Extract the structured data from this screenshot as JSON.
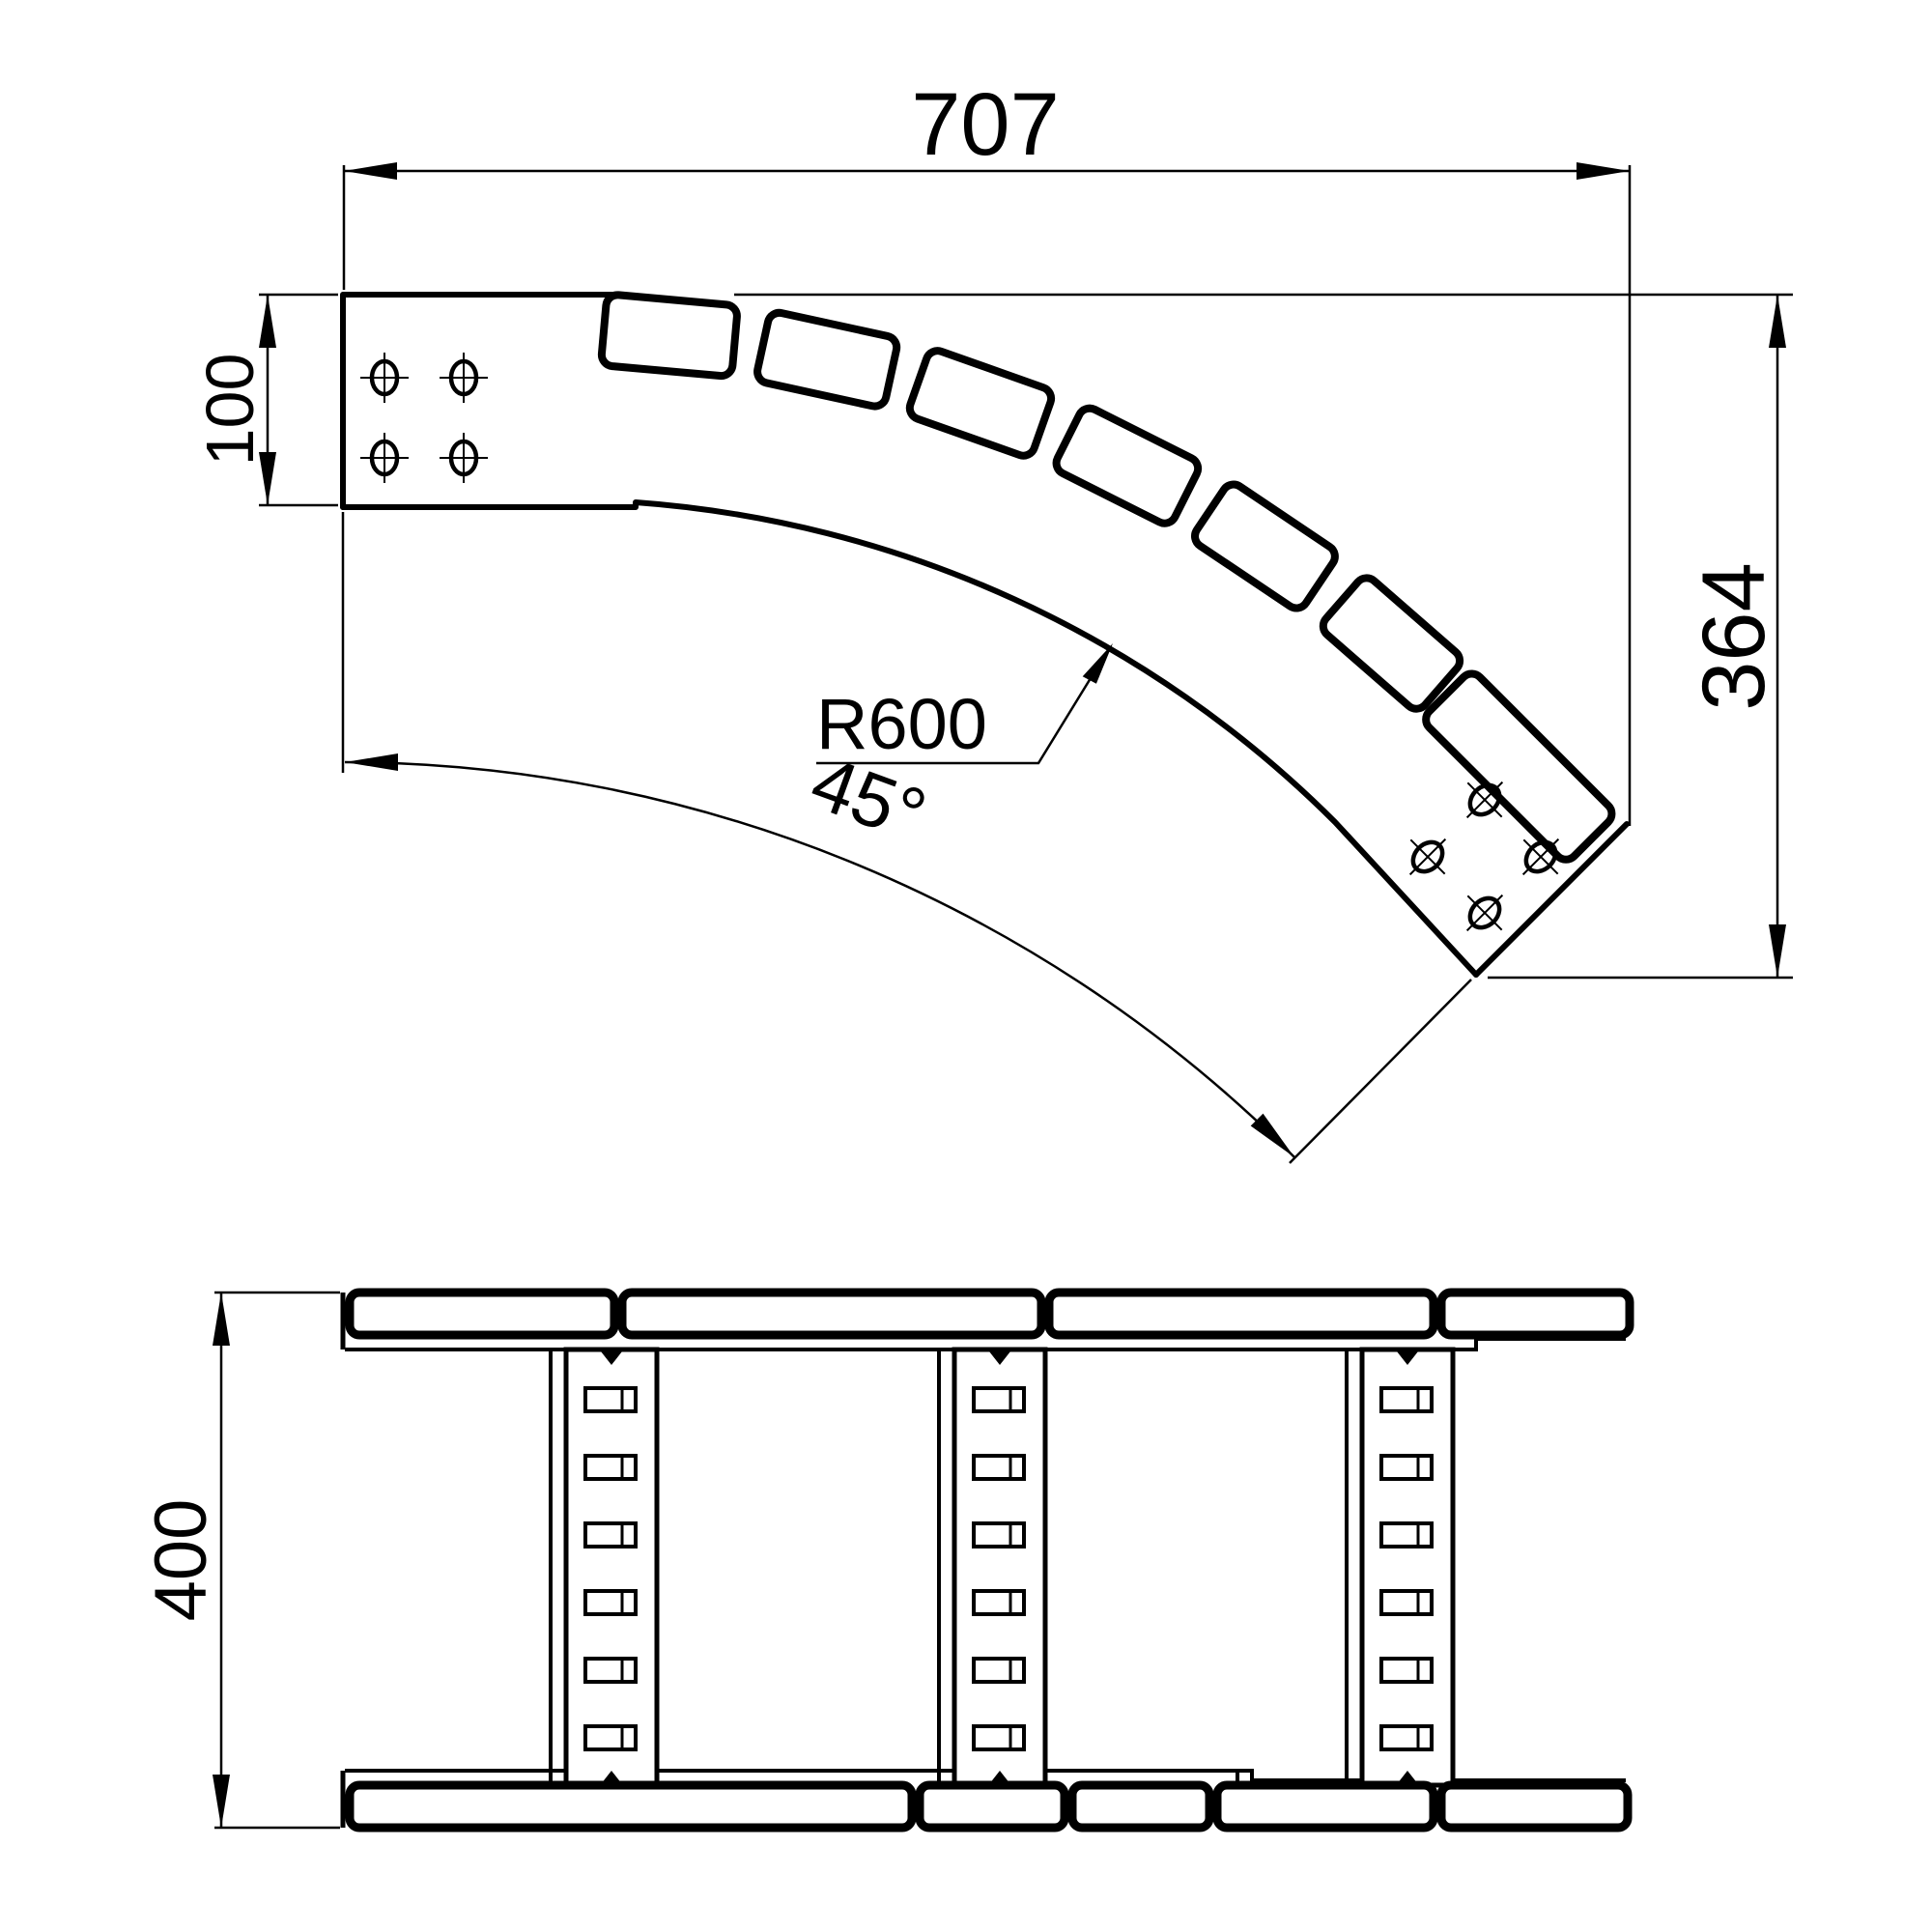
{
  "page": {
    "background": "#ffffff",
    "line_color": "#000000"
  },
  "top_view": {
    "dim_width": "707",
    "dim_end_width": "100",
    "radius_label": "R600",
    "angle_label": "45°",
    "dim_height": "364"
  },
  "plan_view": {
    "dim_width": "400"
  }
}
